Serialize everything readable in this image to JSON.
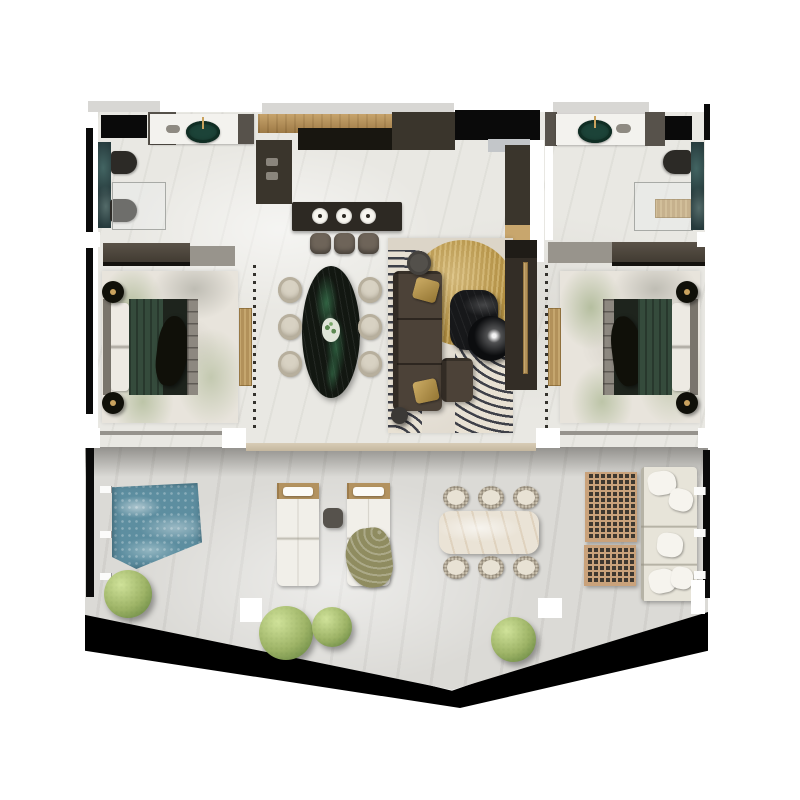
{
  "scene": {
    "type": "photorealistic-3d-floor-plan-render",
    "background": "#ffffff",
    "units": "none",
    "visible_text": ""
  },
  "palette": {
    "interior_floor": "#e9e8e3",
    "terrace_floor": "#dbdad6",
    "wall_dark": "#57524b",
    "wall_black": "#0a0a0a",
    "wood_counter": "#b48f57",
    "cabinet_dark": "#3a352c",
    "island_dark": "#2d2923",
    "entry_wood": "#c8a66d",
    "teal_marble": "#263a3c",
    "sink_green": "#1c4338",
    "gold_accent": "#b2915a",
    "bed_green": "#354b3c",
    "blanket_black": "#101009",
    "headboard_gray": "#8d8880",
    "bedroom_rug_base": "#e8e4dc",
    "living_rug_base": "#dcd5c8",
    "rug_gold": "#b18e41",
    "sofa_brown": "#4c4238",
    "dining_marble": "#121711",
    "chair_cream": "#d8d2c3",
    "coffee_table_black": "#17181a",
    "coffee_table_gloss": "#0c0d0f",
    "tv_wall": "#332d26",
    "pool_water": "#5d8ea0",
    "bush_green": "#9db366",
    "lounger_white": "#f1efe9",
    "lounger_wood": "#b3925f",
    "towel_olive": "#8f8c60",
    "outdoor_table": "#eae3d6",
    "wicker": "#cdc4b2",
    "lattice_tan": "#c9a27b",
    "lattice_dark": "#3e3830",
    "outdoor_sofa": "#e7e4d9"
  },
  "rooms": {
    "bathroom_left": {
      "fixtures": [
        "vanity-counter",
        "green-stone-sink",
        "toilet",
        "bidet",
        "glass-shower",
        "teal-marble-wall"
      ]
    },
    "kitchen": {
      "fixtures": [
        "wood-counter",
        "tall-cabinets",
        "island",
        "pendant-lights",
        "bar-stools"
      ],
      "bar_stool_count": 3,
      "pendant_light_count": 3
    },
    "entry": {
      "fixtures": [
        "entry-door-recess",
        "wood-floor-strip",
        "tall-cabinet"
      ]
    },
    "bathroom_right": {
      "fixtures": [
        "vanity-counter",
        "green-stone-sink",
        "toilet",
        "gold-bench",
        "glass-shower",
        "teal-marble-wall"
      ]
    },
    "bedroom_left": {
      "furnishings": [
        "double-bed-green-duvet",
        "round-nightstands",
        "botanical-rug",
        "wardrobe-band",
        "gold-console",
        "slatted-partition"
      ],
      "nightstand_count": 2
    },
    "dining_area": {
      "furnishings": [
        "oval-green-marble-table",
        "cream-chairs",
        "flower-centerpiece"
      ],
      "chair_count": 6
    },
    "living_area": {
      "furnishings": [
        "l-shaped-sectional-sofa",
        "gold-circle-rug",
        "square-coffee-table",
        "round-coffee-table",
        "ottoman",
        "side-table",
        "gold-throw-pillows",
        "tv-media-wall"
      ]
    },
    "bedroom_right": {
      "furnishings": [
        "double-bed-green-duvet",
        "round-nightstands",
        "botanical-rug",
        "wardrobe-band",
        "gold-console",
        "slatted-partition"
      ],
      "nightstand_count": 2
    },
    "terrace": {
      "furnishings": [
        "plunge-pool",
        "glass-railing",
        "sun-loungers",
        "olive-towel",
        "side-table",
        "marble-dining-table",
        "wicker-chairs",
        "lattice-coffee-tables",
        "outdoor-sofa",
        "topiary-bushes"
      ],
      "lounger_count": 2,
      "wicker_chair_count": 6,
      "bush_count": 4,
      "sofa_seat_count": 3
    }
  }
}
